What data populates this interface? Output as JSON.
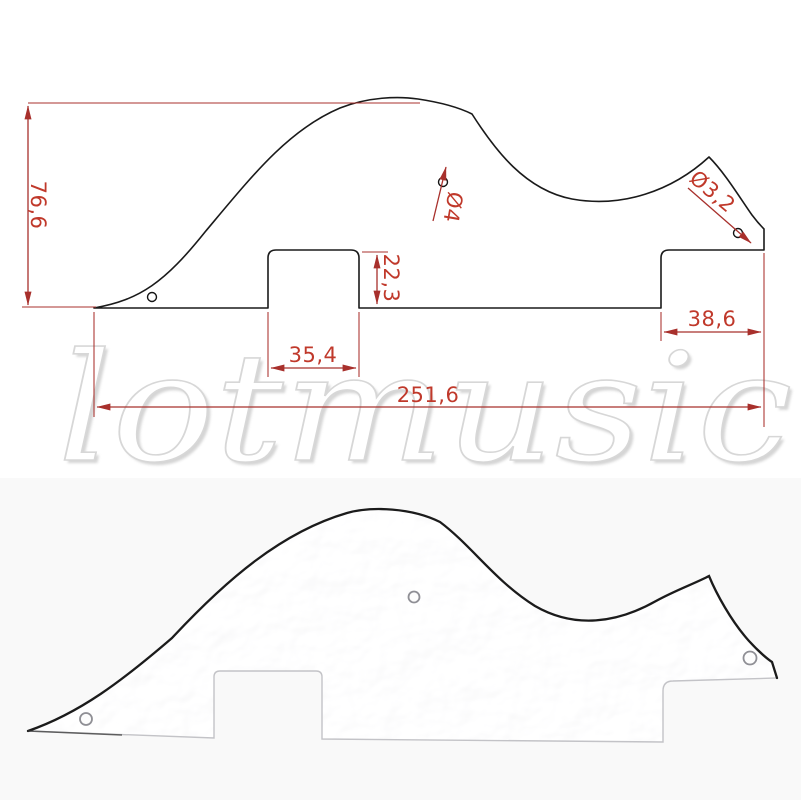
{
  "watermark": {
    "text": "lotmusic"
  },
  "drawing": {
    "labels": {
      "overall_height": "76,6",
      "mount_hole_diameter": "Ø4",
      "corner_hole_diameter": "Ø3,2",
      "pickup_notch_depth": "22,3",
      "pickup_notch_width": "35,4",
      "bridge_step_width": "38,6",
      "overall_length": "251,6"
    },
    "colors": {
      "dimension_line_red": "#a8302c",
      "dimension_text_red": "#c0392b",
      "outline_black": "#1a1a1a"
    }
  }
}
